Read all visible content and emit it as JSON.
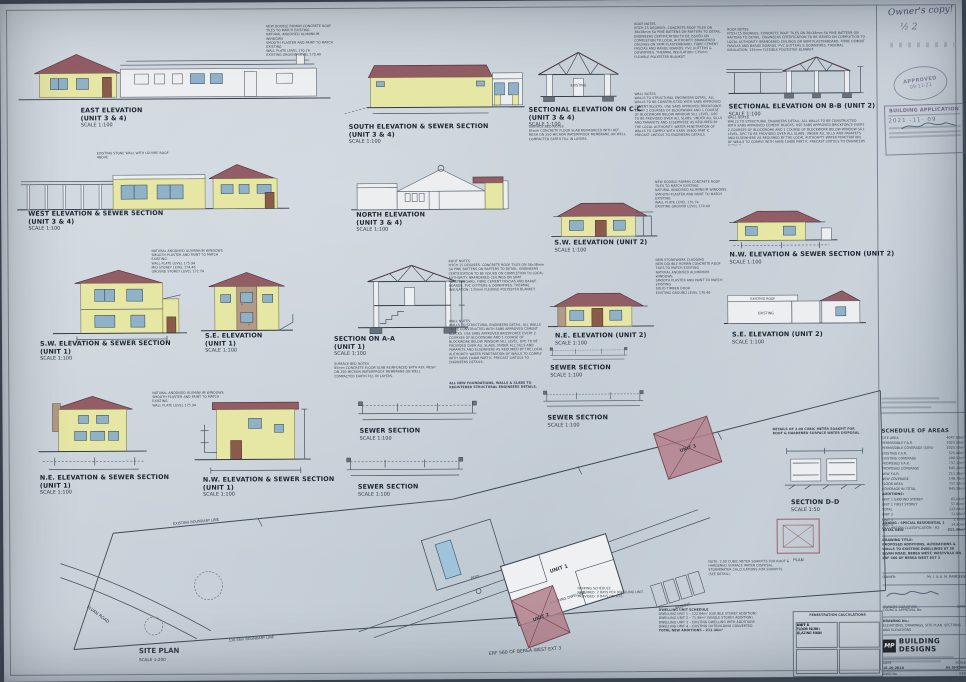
{
  "panels": [
    {
      "title": "EAST ELEVATION",
      "unit": "(UNIT 3 & 4)",
      "scale": "SCALE 1:100"
    },
    {
      "title": "SOUTH ELEVATION & SEWER SECTION",
      "unit": "(UNIT 3 & 4)",
      "scale": "SCALE 1:100"
    },
    {
      "title": "SECTIONAL ELEVATION ON C-C",
      "unit": "(UNIT 3 & 4)",
      "scale": "SCALE 1:100"
    },
    {
      "title": "SECTIONAL ELEVATION ON B-B (UNIT 2)",
      "unit": "",
      "scale": "SCALE 1:100"
    },
    {
      "title": "WEST ELEVATION & SEWER SECTION",
      "unit": "(UNIT 3 & 4)",
      "scale": "SCALE 1:100"
    },
    {
      "title": "NORTH ELEVATION",
      "unit": "(UNIT 3 & 4)",
      "scale": "SCALE 1:100"
    },
    {
      "title": "S.W. ELEVATION (UNIT 2)",
      "unit": "",
      "scale": "SCALE 1:100"
    },
    {
      "title": "N.W. ELEVATION & SEWER SECTION (UNIT 2)",
      "unit": "",
      "scale": "SCALE 1:100"
    },
    {
      "title": "S.W. ELEVATION & SEWER SECTION",
      "unit": "(UNIT 1)",
      "scale": "SCALE 1:100"
    },
    {
      "title": "S.E. ELEVATION",
      "unit": "(UNIT 1)",
      "scale": "SCALE 1:100"
    },
    {
      "title": "SECTION ON A-A",
      "unit": "(UNIT 1)",
      "scale": "SCALE 1:100"
    },
    {
      "title": "N.E. ELEVATION (UNIT 2)",
      "unit": "",
      "scale": "SCALE 1:100"
    },
    {
      "title": "S.E. ELEVATION (UNIT 2)",
      "unit": "",
      "scale": "SCALE 1:100"
    },
    {
      "title": "SEWER SECTION",
      "unit": "",
      "scale": "SCALE 1:100"
    },
    {
      "title": "N.E. ELEVATION & SEWER SECTION",
      "unit": "(UNIT 1)",
      "scale": "SCALE 1:100"
    },
    {
      "title": "N.W. ELEVATION & SEWER SECTION",
      "unit": "(UNIT 1)",
      "scale": "SCALE 1:100"
    },
    {
      "title": "SEWER SECTION",
      "unit": "",
      "scale": "SCALE 1:100"
    },
    {
      "title": "SEWER SECTION",
      "unit": "",
      "scale": "SCALE 1:100"
    },
    {
      "title": "SEWER SECTION",
      "unit": "",
      "scale": "SCALE 1:100"
    }
  ],
  "soak": {
    "t1": "DETAILS OF 2.00 CUBIC METER SOAKPIT FOR",
    "t2": "ROOF & HARDENED SURFACE WATER DISPOSAL",
    "section": "SECTION D-D",
    "scale": "SCALE 1:50",
    "plan": "PLAN"
  },
  "ann": {
    "tiles": "NEW DOUBLE ROMAN CONCRETE ROOF TILES TO MATCH EXISTING",
    "abut": "FIBRE CEMENT ABUTMENT BOARD",
    "exroof": "EXISTING ROOF",
    "existing": "EXISTING",
    "win": "NATURAL ANODISED ALUMINIUM WINDOWS",
    "plaster": "SMOOTH PLASTER AND PAINT TO MATCH EXISTING",
    "stone": "NEW STONEWORK CLADDING",
    "door": "SOLID TIMBER DOOR",
    "wallplate": "WALL PLATE LEVEL 170.74",
    "ground": "EXISTING GROUND LEVEL 170.49",
    "wallplate1": "WALL PLATE LEVEL 175.94",
    "midstorey": "MID STOREY LEVEL 174.46",
    "groundstorey": "GROUND STOREY LEVEL 172.74",
    "stonewall": "EXISTING STONE WALL WITH LOUVRE ROOF ABOVE"
  },
  "notes": {
    "roof": "ROOF NOTES\nPITCH 15 DEGREES. CONCRETE ROOF TILES ON 38x38mm SA PINE BATTENS ON RAFTERS TO DETAIL. ENGINEERS CERTIFICATION TO BE ISSUED ON COMPLETION TO LOCAL AUTHORITY. BRANDERED CEILINGS ON SKIM PLASTERBOARD. FIBRE CEMENT FASCIAS AND BARGE BOARDS. PVC GUTTERS & DOWNPIPES. THERMAL INSULATION: 135mm FLEXIBLE POLYESTER BLANKET.",
    "wall": "WALL NOTES\nWALLS TO STRUCTURAL ENGINEERS DETAIL. ALL WALLS TO BE CONSTRUCTED WITH SABS APPROVED CEMENT BLOCKS. USE SABS APPROVED BRICKFORCE EVERY 2 COURSES OF BLOCKWORK AND 1 COURSE OF BLOCKWORK BELOW WINDOW SILL LEVEL. DPC TO BE PROVIDED OVER ALL SLABS, UNDER ALL SILLS AND PARAPETS AND ELSEWHERE AS REQUIRED BY THE LOCAL AUTHORITY. WATER PENETRATION OF WALLS TO COMPLY WITH SANS 10400 PART K. PRECAST LINTOLS TO ENGINEERS DETAILS.",
    "surface": "SURFACE BED NOTES\n85mm CONCRETE FLOOR SLAB REINFORCED WITH REF. MESH ON 250 MICRON WATERPROOF MEMBRANE ON WELL COMPACTED EARTH FILL IN LAYERS.",
    "general": "ALL NEW FOUNDATIONS, WALLS & SLABS TO REGISTERED STRUCTURAL ENGINEERS DETAILS.",
    "soaknote": "NOTE: 2.00 CUBIC METER SOAKPITS FOR ROOF & HARDENED SURFACE WATER DISPOSAL. STORMWATER CALCULATIONS FOR SOAKPITS (SEE DETAIL).",
    "parking": "PARKING SCHEDULE\nREQUIRED: 2 BAYS PER DWELLING UNIT.\nPROVIDED: 8 BAYS ON SITE."
  },
  "site": {
    "title": "SITE PLAN",
    "scale": "SCALE 1:200",
    "erf": "ERF 560 OF BEREA WEST EXT 3",
    "road": "ELVAN ROAD",
    "btop": "EXISTING BOUNDARY LINE",
    "bbot": "130.56m BOUNDARY LINE",
    "u1": "UNIT 1",
    "u2": "UNIT 2",
    "u3": "UNIT 3",
    "exist": "EXISTING DWELLING",
    "pool": "POOL",
    "park": "PARKING"
  },
  "schedule": {
    "title": "SCHEDULE OF AREAS",
    "rows": [
      {
        "l": "SITE AREA",
        "v": "4047.00m²"
      },
      {
        "l": "PERMISSIBLE F.A.R.",
        "v": "2023.50m²"
      },
      {
        "l": "PERMISSIBLE COVERAGE (50%)",
        "v": "2023.50m²"
      },
      {
        "l": "EXISTING F.A.R.",
        "v": "525.96m²"
      },
      {
        "l": "EXISTING COVERAGE",
        "v": "498.52m²"
      },
      {
        "l": "PROPOSED F.A.R.",
        "v": "737.32m²"
      },
      {
        "l": "PROPOSED COVERAGE",
        "v": "645.28m²"
      },
      {
        "l": "NEW F.A.R.",
        "v": "211.36m²"
      },
      {
        "l": "NEW COVERAGE",
        "v": "146.76m²"
      },
      {
        "l": "FLOOR AREA",
        "v": "737.32m²"
      },
      {
        "l": "COVERAGE IN TOTAL",
        "v": "645.28m²"
      }
    ],
    "additions_title": "ADDITIONS:",
    "additions": [
      {
        "l": "UNIT 1  GROUND STOREY",
        "v": "65.04m²"
      },
      {
        "l": "UNIT 1  FIRST STOREY",
        "v": "57.80m²"
      },
      {
        "l": "TOTAL",
        "v": "122.84m²"
      },
      {
        "l": "UNIT 2",
        "v": "71.96m²"
      },
      {
        "l": "UNIT 3",
        "v": "1.76m²"
      },
      {
        "l": "UNIT 4",
        "v": "14.80m²"
      }
    ],
    "total": {
      "l": "TOTAL NEW",
      "v": "211.36m²"
    }
  },
  "fen": {
    "caption": "FENESTRATION CALCULATIONS",
    "units": [
      {
        "name": "UNIT 1",
        "floor": "FLOOR 122.84",
        "glaz": "GLAZING 19.20"
      },
      {
        "name": "UNIT 2",
        "floor": "FLOOR 71.96",
        "glaz": "GLAZING 11.10"
      },
      {
        "name": "UNIT 3",
        "floor": "FLOOR 64.30",
        "glaz": "GLAZING 9.80"
      },
      {
        "name": "UNIT 4",
        "floor": "FLOOR 14.80",
        "glaz": "GLAZING 2.40"
      }
    ]
  },
  "dwell": {
    "heading": "DWELLING UNIT SCHEDULE",
    "lines": [
      "DWELLING UNIT 1 – 122.84m² (DOUBLE STOREY ADDITION)",
      "DWELLING UNIT 2 – 71.96m² (SINGLE STOREY ADDITION)",
      "DWELLING UNIT 3 – EXISTING DWELLING WITH ADDITIONS",
      "DWELLING UNIT 4 – EXISTING OUTBUILDING CONVERTED",
      "TOTAL NEW ADDITIONS – 211.36m²"
    ]
  },
  "tb": {
    "zoning": "ZONING : SPECIAL RESIDENTIAL 1",
    "classification": "OCCUPATION CLASSIFICATION : H3",
    "drawing_title_label": "DRAWING TITLE:",
    "drawing_title": "PROPOSED ADDITIONS, ALTERATIONS & WALLS TO EXISTING DWELLINGS AT 30 ELVAN ROAD, BEREA WEST, WESTVILLE ON ERF 560 OF BEREA WEST EXT 3",
    "owner_label": "OWNER:",
    "owner": "Mr. I. & A. M. RAMDEEN",
    "owners_signature_label": "OWNERS SIGNATURE",
    "date_small_label": "DATE",
    "council_label": "COUNCIL APPROVAL No.",
    "drawing_no_label": "DRAWING No.:",
    "drawing_content": "ELEVATIONS, DRAWINGS, SITE PLAN, SECTIONS AND ELEVATIONS",
    "logo_initials": "MP",
    "logo_l1": "BUILDING",
    "logo_l2": "DESIGNS",
    "date_label": "DATE",
    "date": "16.10.2018",
    "scale_label": "SCALE",
    "scale": "AS SHOWN",
    "dwg_label": "DWG No.",
    "rev_label": "REV"
  },
  "stamps": {
    "note": "Owner's copy!",
    "note2": "½   2",
    "oval1": "APPROVED",
    "oval2": "09·11·21",
    "app": "BUILDING APPLICATION",
    "app_date": "2021 -11- 09"
  }
}
